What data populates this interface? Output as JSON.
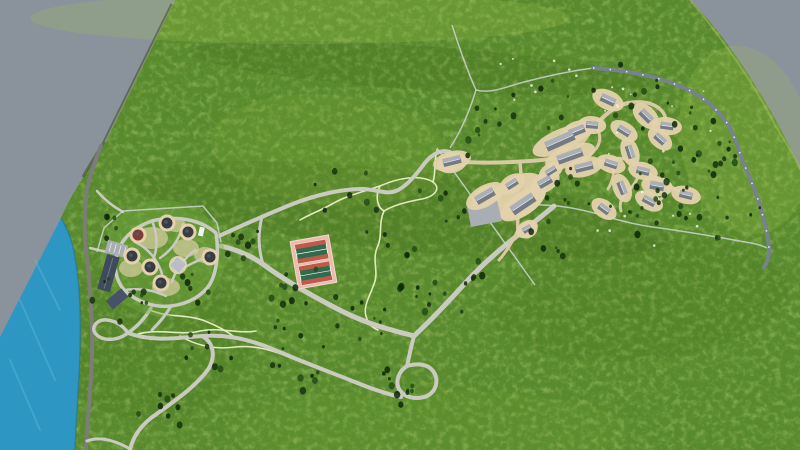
{
  "colors": {
    "void": "#8a929b",
    "water": "#2e96c2",
    "water_hi": "#64b9d9",
    "grass": "#5a8c2e",
    "road": "#c9cbc0",
    "road_dark": "#7c7d79",
    "road_blue": "#76838f",
    "road_dash": "#eef2f5",
    "trail": "#e9eec6",
    "fence": "#cdd3cf",
    "path_tan": "#d8c9a4",
    "pad_tan": "#e3d2ac",
    "court_pad": "#e9bcab",
    "court_green": "#2f6b4c",
    "court_red": "#bf5a4a",
    "court_line": "#f4f6f0",
    "roof_light": "#aab0b8",
    "roof_dark": "#747a83",
    "roof_ridge": "#e8eaec",
    "hut_roof": "#383d44",
    "hut_red": "#7e3b38",
    "lodge_roof": "#3f4a5c",
    "lodge_wing": "#46516a",
    "parking": "#a9aeb3",
    "pavilion": "#b9bec4",
    "vehicle": "#f2f2f2",
    "tree1": "#16330e",
    "tree2": "#234b15",
    "tree3": "#0e2609",
    "speck": "#f5f7ee"
  },
  "settlement_houses": [
    [
      608,
      100,
      25,
      15,
      8
    ],
    [
      646,
      116,
      45,
      14,
      8
    ],
    [
      667,
      126,
      8,
      13,
      7
    ],
    [
      624,
      131,
      32,
      13,
      7
    ],
    [
      660,
      139,
      42,
      12,
      7
    ],
    [
      592,
      125,
      5,
      12,
      7
    ],
    [
      577,
      131,
      -22,
      16,
      8
    ],
    [
      560,
      141,
      -24,
      30,
      10
    ],
    [
      570,
      156,
      -20,
      26,
      9
    ],
    [
      584,
      167,
      -14,
      18,
      8
    ],
    [
      630,
      152,
      72,
      13,
      7
    ],
    [
      611,
      164,
      18,
      13,
      7
    ],
    [
      643,
      171,
      14,
      13,
      7
    ],
    [
      657,
      186,
      10,
      14,
      8
    ],
    [
      622,
      188,
      68,
      13,
      7
    ],
    [
      649,
      201,
      28,
      13,
      7
    ],
    [
      686,
      195,
      14,
      13,
      7
    ],
    [
      604,
      209,
      36,
      12,
      7
    ],
    [
      545,
      182,
      -30,
      14,
      8
    ],
    [
      551,
      171,
      -32,
      11,
      6
    ],
    [
      512,
      184,
      -32,
      12,
      7
    ],
    [
      523,
      204,
      -34,
      26,
      10
    ],
    [
      485,
      196,
      -30,
      20,
      9
    ],
    [
      452,
      161,
      -14,
      18,
      8
    ],
    [
      527,
      229,
      -30,
      9,
      6
    ]
  ],
  "compound_huts": [
    [
      167,
      223,
      "dark"
    ],
    [
      188,
      232,
      "dark"
    ],
    [
      210,
      257,
      "dark"
    ],
    [
      150,
      267,
      "dark"
    ],
    [
      132,
      256,
      "dark"
    ],
    [
      161,
      283,
      "dark"
    ],
    [
      138,
      235,
      "red"
    ]
  ],
  "tree_clusters": [
    [
      250,
      247,
      25,
      8,
      11
    ],
    [
      310,
      287,
      30,
      8,
      21
    ],
    [
      362,
      318,
      28,
      8,
      31
    ],
    [
      430,
      300,
      35,
      10,
      41
    ],
    [
      470,
      270,
      25,
      6,
      51
    ],
    [
      408,
      382,
      30,
      10,
      61
    ],
    [
      300,
      363,
      35,
      9,
      71
    ],
    [
      210,
      350,
      30,
      8,
      81
    ],
    [
      160,
      410,
      30,
      8,
      91
    ],
    [
      120,
      300,
      35,
      10,
      101
    ],
    [
      100,
      225,
      25,
      6,
      111
    ],
    [
      190,
      290,
      22,
      6,
      121
    ],
    [
      680,
      150,
      60,
      30,
      131
    ],
    [
      640,
      210,
      40,
      12,
      141
    ],
    [
      570,
      190,
      30,
      8,
      151
    ],
    [
      480,
      130,
      40,
      8,
      161
    ],
    [
      530,
      100,
      40,
      7,
      171
    ],
    [
      620,
      85,
      40,
      8,
      181
    ],
    [
      720,
      210,
      40,
      10,
      191
    ],
    [
      560,
      235,
      30,
      6,
      201
    ],
    [
      350,
      200,
      40,
      7,
      211
    ],
    [
      390,
      240,
      30,
      6,
      221
    ],
    [
      280,
      320,
      30,
      6,
      231
    ],
    [
      440,
      200,
      30,
      6,
      241
    ]
  ],
  "speck_clusters": [
    [
      650,
      120,
      70,
      12,
      301
    ],
    [
      540,
      85,
      50,
      8,
      311
    ],
    [
      640,
      225,
      60,
      8,
      321
    ]
  ]
}
